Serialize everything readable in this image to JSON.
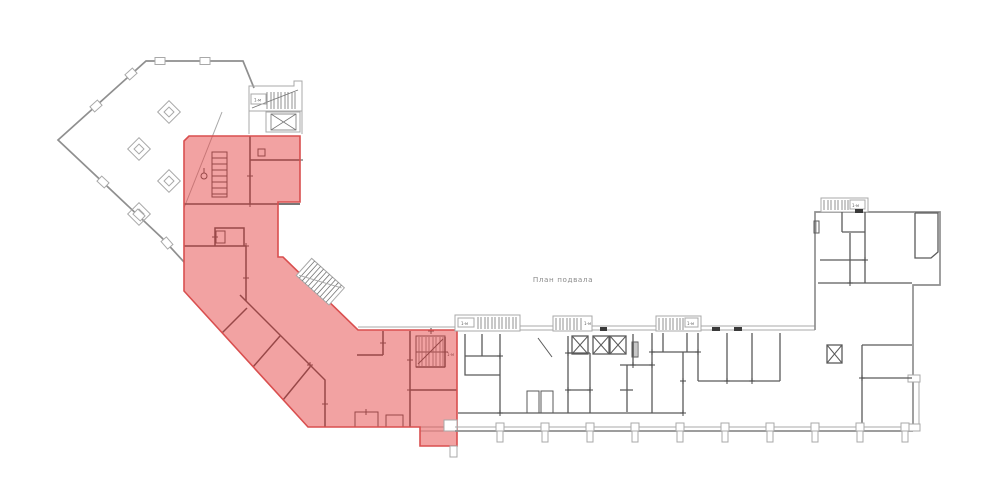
{
  "drawing": {
    "caption": "План подвала",
    "stair_label": "1-м"
  },
  "colors": {
    "background": "#ffffff",
    "outline": "#8f8f8f",
    "outline_light": "#a8a8a8",
    "wall_dark": "#4a4a4a",
    "wall_mid": "#5a5a5a",
    "detail": "#767676",
    "threshold": "#3a3a3a",
    "text": "#8a8a8a",
    "highlight_fill": "rgba(230,70,70,0.5)",
    "highlight_stroke": "#d94f4f"
  },
  "symbols": {
    "column_marker_icon": "diamond-column-marker",
    "elevator_icon": "crossed-square-shaft",
    "staircase_icon": "hatched-stair-run",
    "highlight_region": "selected-basement-zone"
  }
}
